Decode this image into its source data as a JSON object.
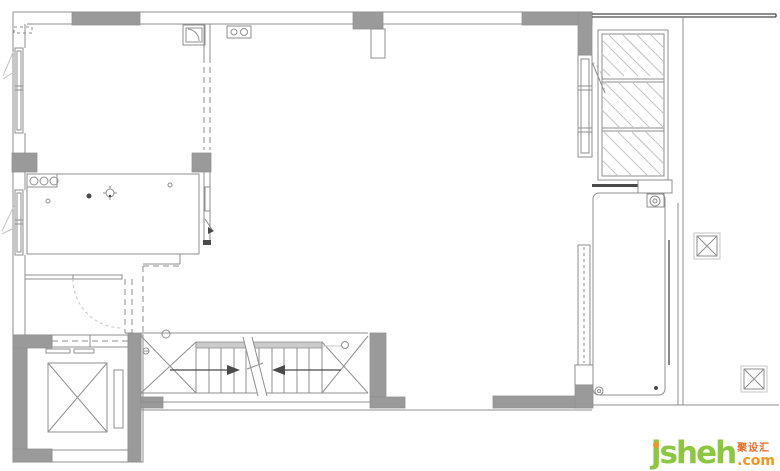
{
  "watermark": {
    "brand": "jsheh",
    "tld": ".com",
    "cjk": "聚设汇",
    "colors": {
      "brand": "#8dc63f",
      "tld": "#f7941d",
      "cjk": "#f26522",
      "j_dot": "#f7941d"
    }
  },
  "palette": {
    "background": "#ffffff",
    "wall_fill": "#9a9a9a",
    "line": "#8f8f8f",
    "line_light": "#c5c5c5",
    "line_dark": "#4a4a4a",
    "landing_fill": "#cbcbcb"
  },
  "plan": {
    "symbols": {
      "elevator_car": "square-with-x-diagonals",
      "structural_column": "square-with-x-diagonals",
      "wardrobe": "rect-with-diagonal-hatch-3-cells",
      "stair_direction_arrows": "two-opposed-filled-triangles",
      "washing_machine": "circle-in-square",
      "floor_drain": "concentric-circles",
      "cooktop_burners": "three-circles-row",
      "hob_two_burner": "two-circles-in-rect",
      "sink": "square-with-quarter-arc",
      "window": "double-line-in-wall",
      "door_swing": "quarter-arc-dashed"
    },
    "stairs": {
      "tread_lines": 11,
      "arrows": 2
    },
    "columns": 2,
    "wardrobe_cells": 3
  }
}
